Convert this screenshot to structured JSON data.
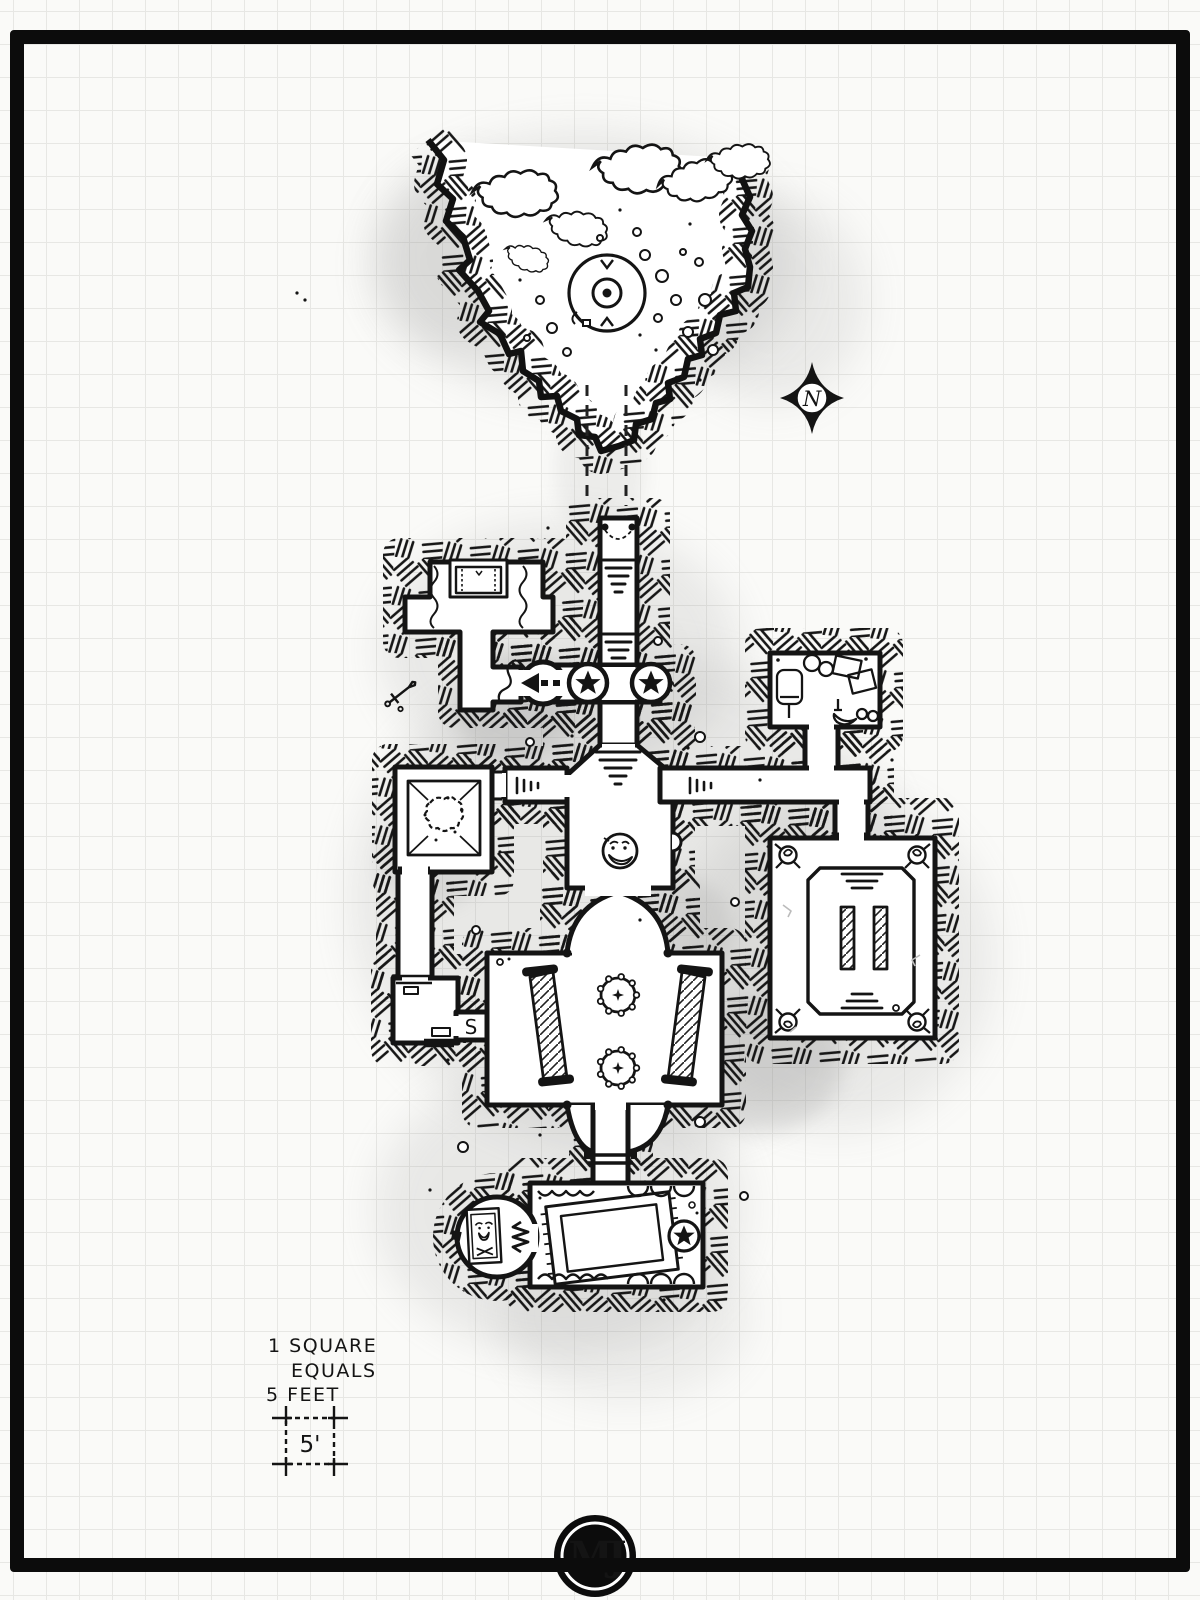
{
  "page": {
    "paper_color": "#fafaf8",
    "grid_color": "#e7e7e4",
    "frame_color": "#0c0c0c",
    "ink_color": "#141414",
    "wash_color": "#8f8f8f"
  },
  "compass": {
    "label": "N"
  },
  "scale_note": {
    "lines": [
      "1 SQUARE",
      "EQUALS",
      "5 FEET"
    ],
    "box_label": "5'"
  },
  "map": {
    "secret_door_label": "S",
    "features": [
      "cave-entrance",
      "scrub-bushes",
      "rubble",
      "sinkhole-well",
      "hidden-path",
      "compass-rose",
      "entrance-stairs",
      "star-seal-doors",
      "one-way-arrow",
      "altar-dais-room",
      "curtains",
      "sword-doodle",
      "storage-room-furniture",
      "pyramid-pit-room",
      "secret-door",
      "stair-corridors",
      "pillared-hall",
      "face-medallion",
      "gear-platforms",
      "collapsed-barricades",
      "brazier-corners",
      "pillar-platform-room",
      "rug-chamber",
      "star-seal",
      "jester-sarcophagus-cell",
      "zigzag-passage"
    ]
  },
  "logo": {
    "monogram": "MJ"
  }
}
